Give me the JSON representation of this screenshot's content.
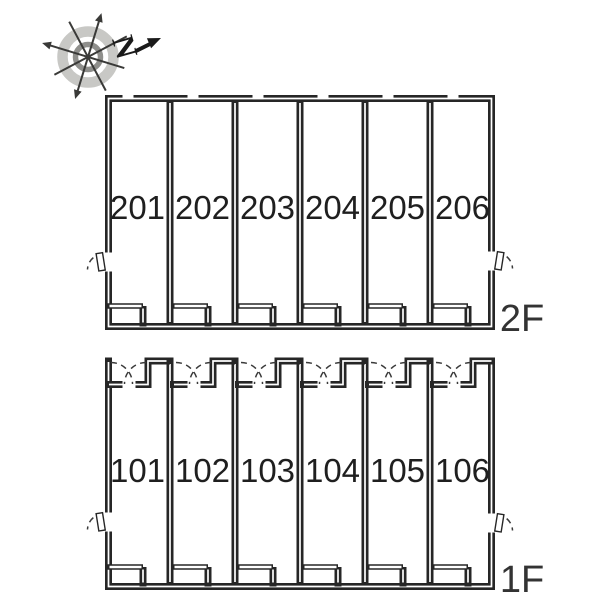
{
  "compass": {
    "north_label": "N",
    "ring_color": "#c8c8c5",
    "inner_ring_color": "#8f8f8c",
    "spoke_color": "#3a3a38",
    "north_color": "#1a1a1a"
  },
  "colors": {
    "background": "#ffffff",
    "wall": "#262626",
    "wall_core": "#ffffff",
    "door_arc": "#3a3a3a",
    "unit_number": "#1f1f1f",
    "floor_label": "#333333"
  },
  "floors": [
    {
      "label": "2F",
      "units": [
        "201",
        "202",
        "203",
        "204",
        "205",
        "206"
      ]
    },
    {
      "label": "1F",
      "units": [
        "101",
        "102",
        "103",
        "104",
        "105",
        "106"
      ]
    }
  ]
}
